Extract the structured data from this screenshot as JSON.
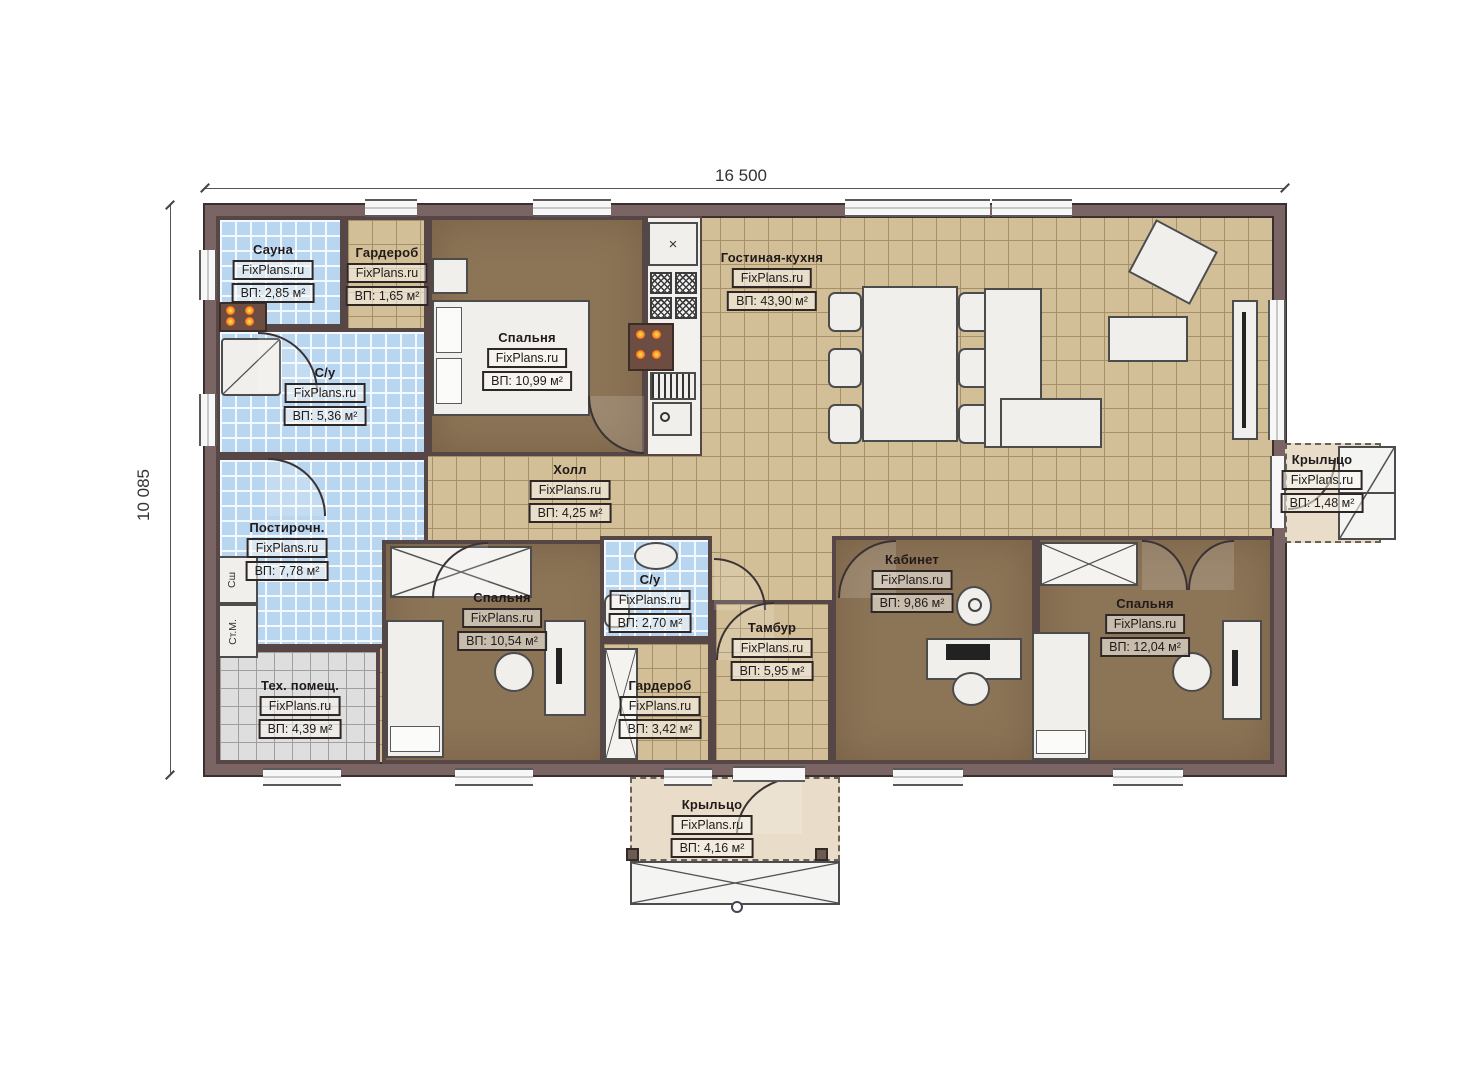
{
  "brand": "FixPlans.ru",
  "dimensions": {
    "width_mm": "16 500",
    "height_mm": "10 085"
  },
  "rooms": [
    {
      "id": "sauna",
      "name": "Сауна",
      "area": "ВП: 2,85 м²"
    },
    {
      "id": "wardrobe-1",
      "name": "Гардероб",
      "area": "ВП: 1,65 м²"
    },
    {
      "id": "bedroom-1",
      "name": "Спальня",
      "area": "ВП: 10,99 м²"
    },
    {
      "id": "living-kitchen",
      "name": "Гостиная-кухня",
      "area": "ВП: 43,90 м²"
    },
    {
      "id": "bathroom-1",
      "name": "С/у",
      "area": "ВП: 5,36 м²"
    },
    {
      "id": "hall",
      "name": "Холл",
      "area": "ВП: 4,25 м²"
    },
    {
      "id": "laundry",
      "name": "Постирочн.",
      "area": "ВП: 7,78 м²"
    },
    {
      "id": "bedroom-2",
      "name": "Спальня",
      "area": "ВП: 10,54 м²"
    },
    {
      "id": "bathroom-2",
      "name": "С/у",
      "area": "ВП: 2,70 м²"
    },
    {
      "id": "tambour",
      "name": "Тамбур",
      "area": "ВП: 5,95 м²"
    },
    {
      "id": "office",
      "name": "Кабинет",
      "area": "ВП: 9,86 м²"
    },
    {
      "id": "bedroom-3",
      "name": "Спальня",
      "area": "ВП: 12,04 м²"
    },
    {
      "id": "tech-room",
      "name": "Тех. помещ.",
      "area": "ВП: 4,39 м²"
    },
    {
      "id": "wardrobe-2",
      "name": "Гардероб",
      "area": "ВП: 3,42 м²"
    },
    {
      "id": "porch-right",
      "name": "Крыльцо",
      "area": "ВП: 1,48 м²"
    },
    {
      "id": "porch-bottom",
      "name": "Крыльцо",
      "area": "ВП: 4,16 м²"
    }
  ],
  "appliances": {
    "dryer": "Сш",
    "washer": "Ст.М."
  }
}
